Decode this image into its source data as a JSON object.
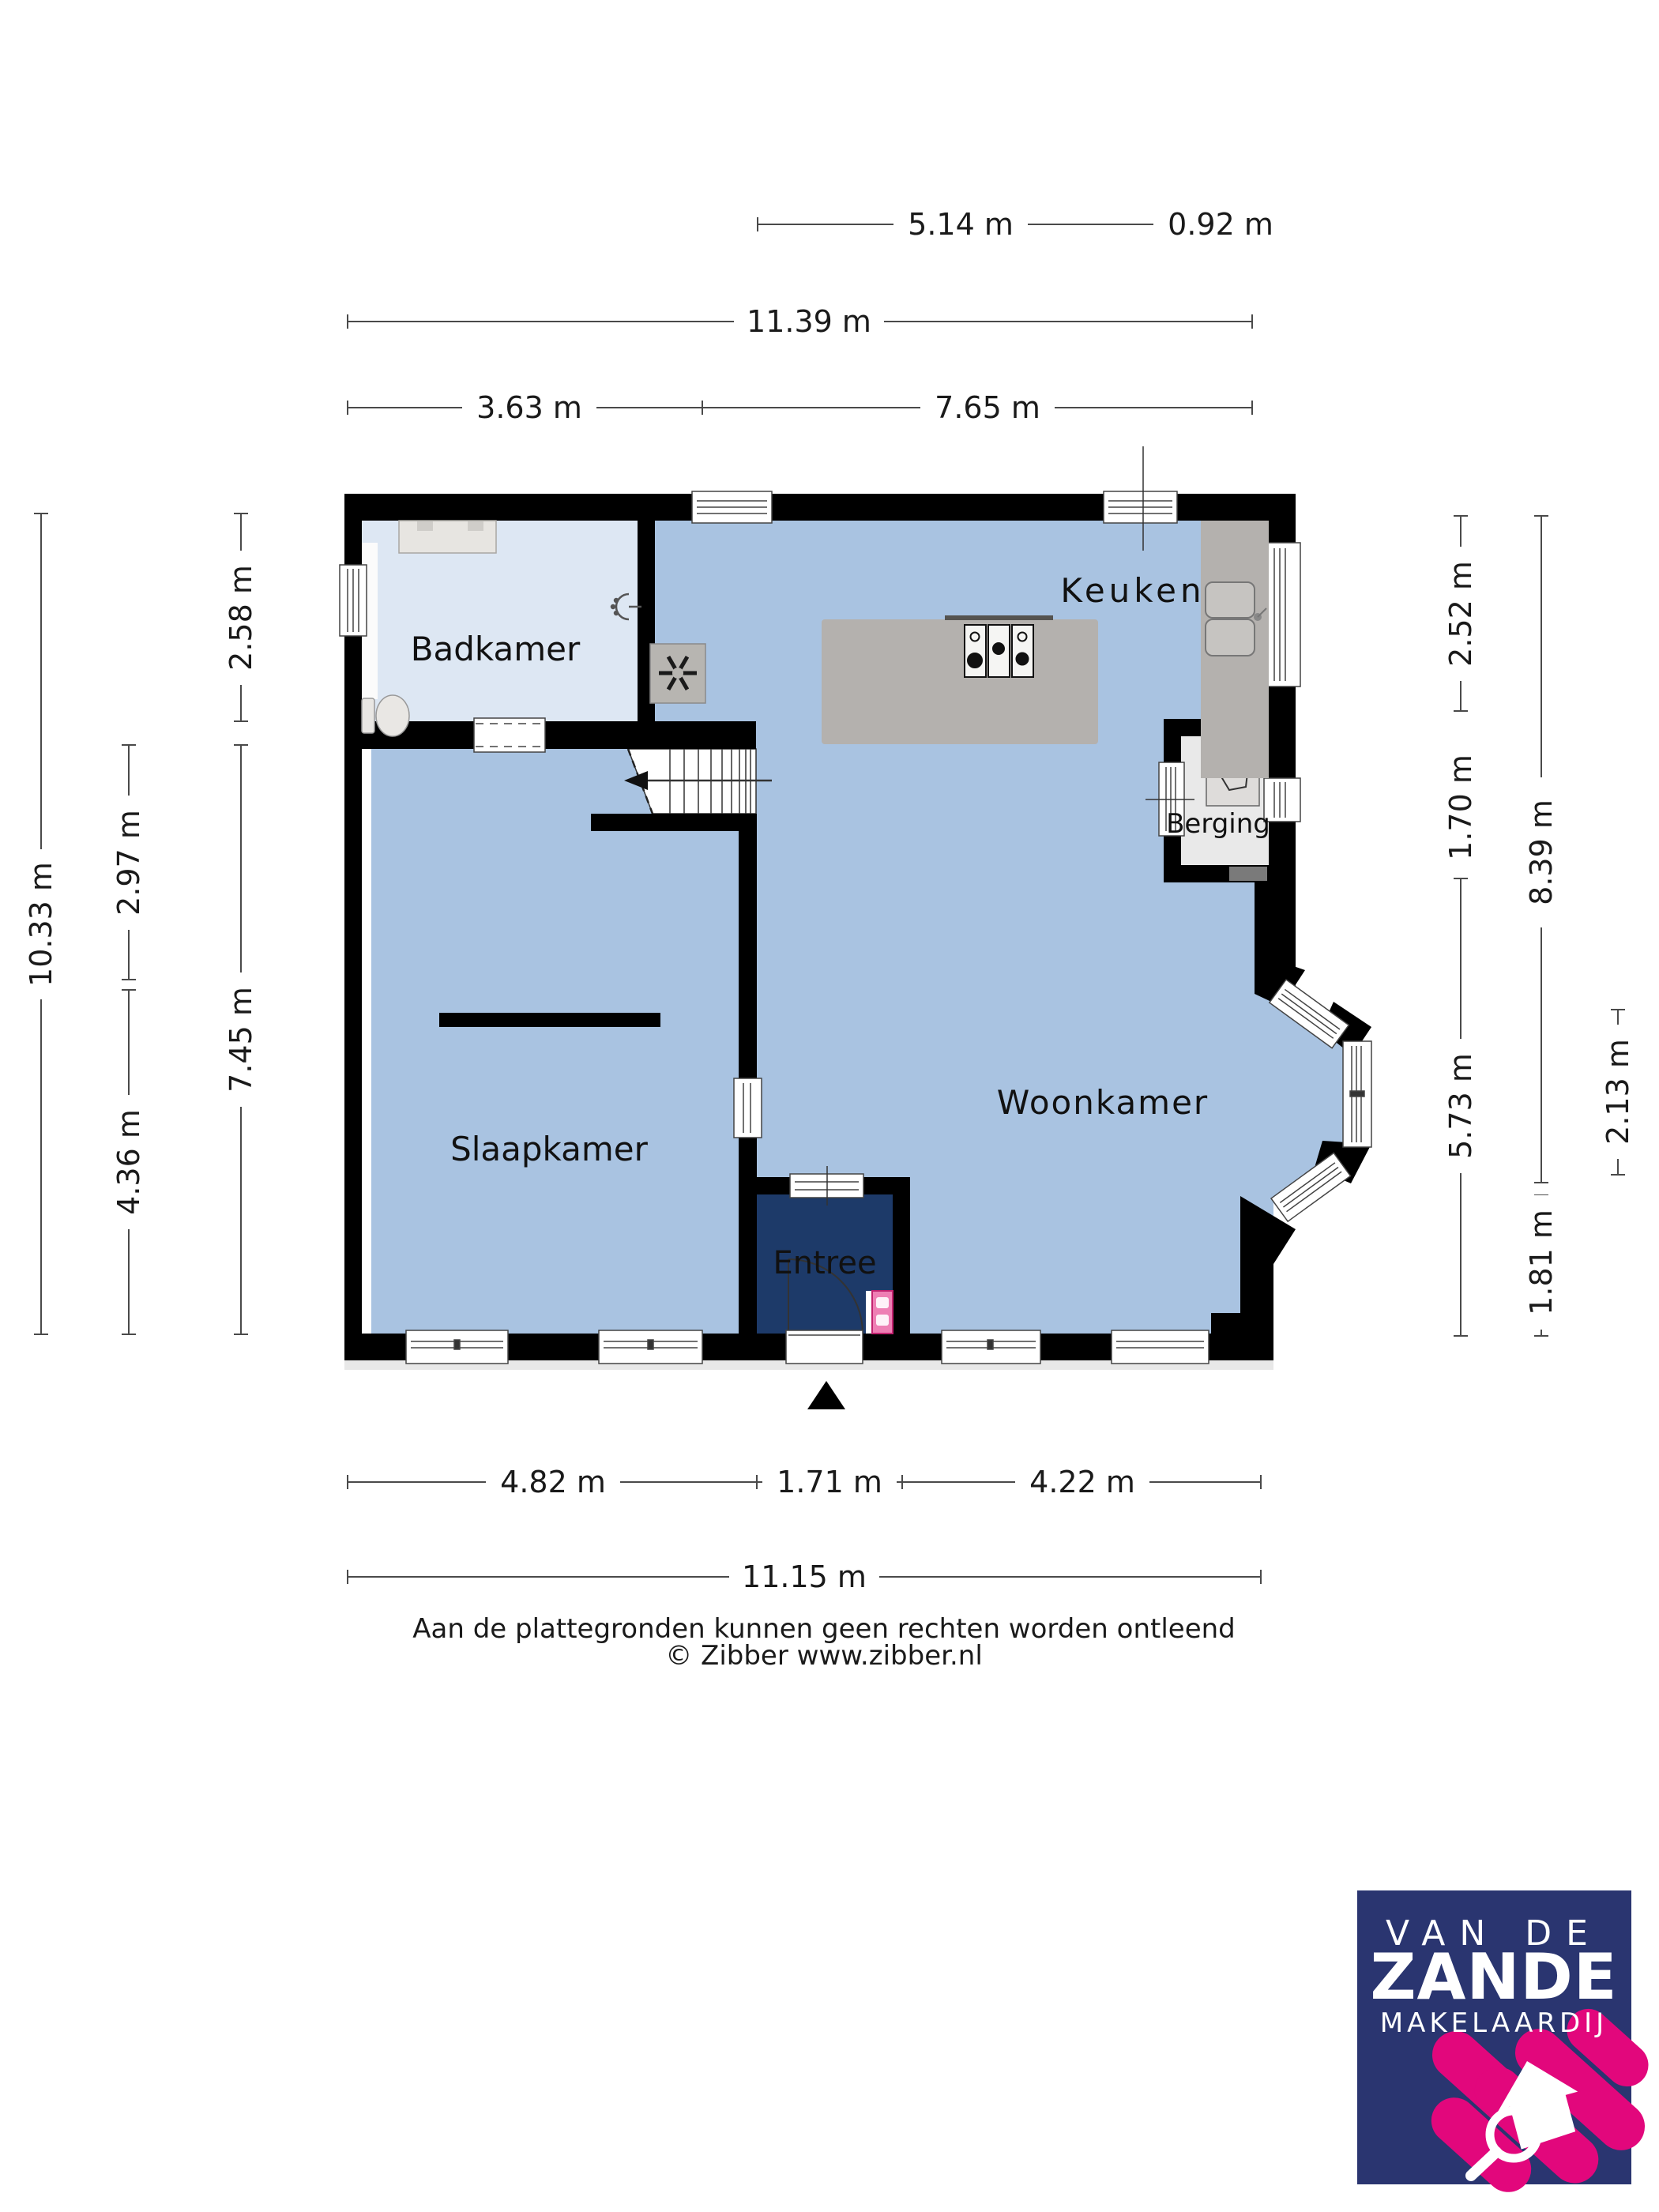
{
  "plan": {
    "type": "floor-plan",
    "floor": "ground-floor",
    "rooms": {
      "badkamer": "Badkamer",
      "keuken": "Keuken",
      "berging": "Berging",
      "slaapkamer": "Slaapkamer",
      "woonkamer": "Woonkamer",
      "entree": "Entree"
    },
    "dims": {
      "d514": "5.14 m",
      "d092": "0.92 m",
      "d1139": "11.39 m",
      "d363": "3.63 m",
      "d765": "7.65 m",
      "d258": "2.58 m",
      "d297": "2.97 m",
      "d1033": "10.33 m",
      "d745": "7.45 m",
      "d436": "4.36 m",
      "d252": "2.52 m",
      "d170": "1.70 m",
      "d573": "5.73 m",
      "d839": "8.39 m",
      "d213": "2.13 m",
      "d181": "1.81 m",
      "d482": "4.82 m",
      "d171": "1.71 m",
      "d422": "4.22 m",
      "d1115": "11.15 m"
    },
    "icons": {
      "stove": "gas-hob-icon",
      "sink": "double-sink-icon",
      "toilet": "toilet-icon",
      "shower": "shower-head-icon",
      "water_heater": "boiler-icon",
      "ventilation": "mechanical-ventilation-icon",
      "stairs": "staircase-up-arrow",
      "entrance": "entrance-triangle-marker",
      "meter_cupboard": "meter-cupboard",
      "door": "door-swing-arc",
      "logo_mark": "house-with-magnifier-icon"
    },
    "colors": {
      "wall": "#000000",
      "room_blue": "#a9c3e1",
      "bathroom_blue": "#dde7f3",
      "entree_navy": "#1d3a69",
      "storage_gray": "#e9e9e9",
      "furniture_gray": "#b4b1ae",
      "logo_navy": "#2a3570",
      "logo_pink": "#e2077c"
    }
  },
  "footer": {
    "disclaimer": "Aan de plattegronden kunnen geen rechten worden ontleend",
    "credit": "© Zibber www.zibber.nl"
  },
  "logo": {
    "line1": "VAN DE",
    "line2": "ZANDE",
    "line3": "MAKELAARDIJ"
  }
}
